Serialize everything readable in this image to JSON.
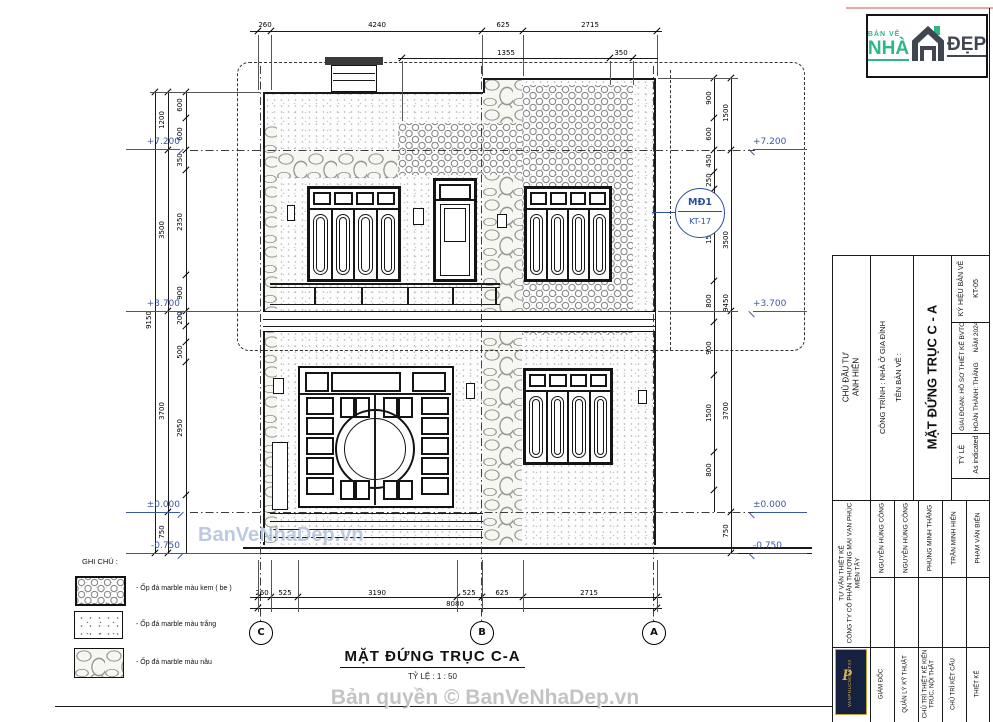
{
  "logo": {
    "top": "BẢN VẼ",
    "name": "NHÀ",
    "suffix": "ĐẸP"
  },
  "watermarks": {
    "mid": "BanVeNhaDep.vn",
    "bottom": "Bản quyền © BanVeNhaDep.vn"
  },
  "drawing": {
    "title": "MẶT ĐỨNG TRỤC C-A",
    "scale_note": "TỶ LỆ : 1 : 50",
    "axes": [
      "C",
      "B",
      "A"
    ],
    "callout": {
      "code": "MĐ1",
      "sheet": "KT-17"
    },
    "levels": {
      "l1": "+7.200",
      "l2": "+3.700",
      "l3": "±0.000",
      "l4": "-0.750"
    },
    "dims": {
      "top": [
        "260",
        "4240",
        "625",
        "2715"
      ],
      "top2": [
        "1355",
        "350"
      ],
      "bottom": [
        "260",
        "525",
        "3190",
        "525",
        "625",
        "2715"
      ],
      "bottom_total": "8080",
      "left_outer": [
        "1200",
        "3500",
        "3700",
        "750"
      ],
      "left_total": "9150",
      "left_inner": [
        "600",
        "600",
        "350",
        "2350",
        "900",
        "200",
        "500",
        "2950"
      ],
      "right_inner": [
        "900",
        "600",
        "450",
        "250",
        "1500",
        "800",
        "900",
        "1500",
        "800"
      ],
      "right_outer": [
        "1500",
        "3500",
        "3700",
        "750"
      ],
      "right_total": "9450"
    }
  },
  "legend": {
    "title": "GHI CHÚ :",
    "items": [
      {
        "label": "- Ốp đá marble màu kem ( be )"
      },
      {
        "label": "- Ốp đá marble màu trắng"
      },
      {
        "label": "- Ốp đá marble màu nâu"
      }
    ]
  },
  "titleblock": {
    "investor_label": "CHỦ ĐẦU TƯ",
    "investor_name": "ANH HIỂN",
    "project": "CÔNG TRÌNH : NHÀ Ở GIA ĐÌNH",
    "sheet_name_label": "TÊN BẢN VẼ :",
    "sheet_title": "MẶT ĐỨNG TRỤC C - A",
    "code_label": "KÝ HIỆU BẢN VẼ",
    "code_value": "KT-05",
    "stage": "GIAI ĐOẠN: HỒ SƠ THIẾT KẾ BVTC",
    "finish": "HOÀN THÀNH: THÁNG",
    "year": "NĂM 2024",
    "scale_label": "TỶ LỆ",
    "scale_value": "As indicated",
    "consultant_label": "TƯ VẤN THIẾT KẾ",
    "consultant_company": "CÔNG TY CỔ PHẦN THƯƠNG MẠI VẠN PHÚC MIỀN TÂY",
    "logo_text": "VANPHUCMIENTAY",
    "people": [
      {
        "role": "GIÁM ĐỐC",
        "name": "NGUYỄN HÙNG CÔNG"
      },
      {
        "role": "QUẢN LÝ KỸ THUẬT",
        "name": "NGUYỄN HÙNG CÔNG"
      },
      {
        "role": "CHỦ TRÌ THIẾT KẾ KIẾN TRÚC, NỘI THẤT",
        "name": "PHÙNG MINH THẮNG"
      },
      {
        "role": "CHỦ TRÌ KẾT CẤU",
        "name": "TRẦN MINH HIỂN"
      },
      {
        "role": "THIẾT KẾ",
        "name": "PHẠM VĂN BIỂN"
      }
    ]
  }
}
